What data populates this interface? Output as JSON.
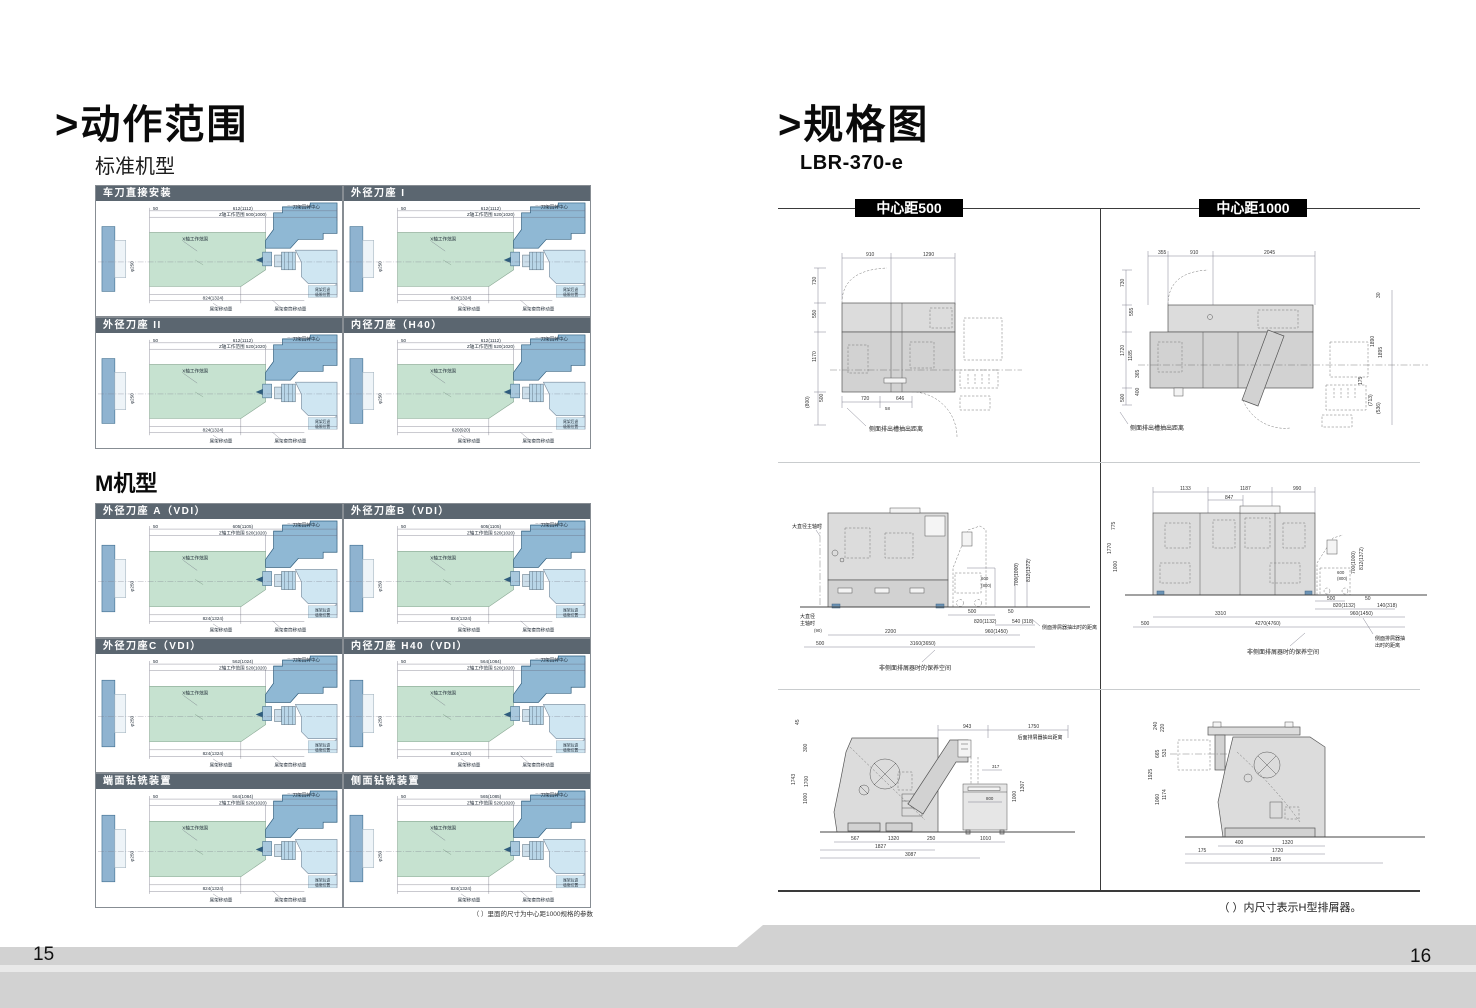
{
  "left_page": {
    "title": ">动作范围",
    "section_standard": "标准机型",
    "section_m": "M机型",
    "footnote": "（ ）里面的尺寸为中心距1000规格的参数",
    "page_number": "15",
    "common": {
      "turret_center": "刀架回转中心",
      "x_range": "X轴工作范围",
      "tailstock_travel": "尾架移动量",
      "quill_travel": "尾架套筒移动量",
      "retract_line1": "尾架后退",
      "retract_line2": "极限位置",
      "dim50": "50",
      "dim_phi": "φ250"
    },
    "standard_panels": [
      {
        "title": "车刀直接安装",
        "top_dim": "612(1112)",
        "z_range": "Z轴工作范围 500(1000)",
        "bottom_dim": "824(1324)"
      },
      {
        "title": "外径刀座 I",
        "top_dim": "612(1112)",
        "z_range": "Z轴工作范围 520(1020)",
        "bottom_dim": "824(1324)"
      },
      {
        "title": "外径刀座 II",
        "top_dim": "612(1112)",
        "z_range": "Z轴工作范围 520(1020)",
        "bottom_dim": "824(1324)"
      },
      {
        "title": "内径刀座（H40）",
        "top_dim": "612(1112)",
        "z_range": "Z轴工作范围 520(1020)",
        "bottom_dim": "620(920)"
      }
    ],
    "m_panels": [
      {
        "title": "外径刀座 A（VDI）",
        "top_dim": "605(1105)",
        "z_range": "Z轴工作范围 520(1020)",
        "bottom_dim": "824(1324)"
      },
      {
        "title": "外径刀座B（VDI）",
        "top_dim": "605(1105)",
        "z_range": "Z轴工作范围 520(1020)",
        "bottom_dim": "824(1324)"
      },
      {
        "title": "外径刀座C（VDI）",
        "top_dim": "562(1024)",
        "z_range": "Z轴工作范围 520(1020)",
        "bottom_dim": "824(1324)"
      },
      {
        "title": "内径刀座 H40（VDI）",
        "top_dim": "564(1084)",
        "z_range": "Z轴工作范围 520(1020)",
        "bottom_dim": "824(1324)"
      },
      {
        "title": "端面钻铣装置",
        "top_dim": "564(1084)",
        "z_range": "Z轴工作范围 520(1020)",
        "bottom_dim": "824(1324)"
      },
      {
        "title": "侧面钻铣装置",
        "top_dim": "565(1085)",
        "z_range": "Z轴工作范围 520(1020)",
        "bottom_dim": "824(1324)"
      }
    ]
  },
  "right_page": {
    "title": ">规格图",
    "model": "LBR-370-e",
    "col1_label": "中心距500",
    "col2_label": "中心距1000",
    "footnote": "（ ）内尺寸表示H型排屑器。",
    "page_number": "16",
    "d500_top": {
      "top": [
        "910",
        "1290"
      ],
      "left": [
        "730",
        "550",
        "1170",
        "(800)",
        "500"
      ],
      "bottom": [
        "720",
        "646",
        "58"
      ],
      "label": "侧面排出槽抽出距离"
    },
    "d1000_top": {
      "top": [
        "355",
        "910",
        "2045"
      ],
      "left": [
        "730",
        "555",
        "1720",
        "1185",
        "365",
        "400",
        "500"
      ],
      "right": [
        "30",
        "1890",
        "1895",
        "175",
        "(713)",
        "(536)"
      ],
      "label": "侧面排出槽抽出距离"
    },
    "d500_front": {
      "spindle_top": "大直径主轴时",
      "spindle_l1": "大直径",
      "spindle_l2": "主轴时",
      "dims": {
        "c600": "600",
        "c800": "(800)",
        "c700": "700(1000)",
        "c812": "812(1372)"
      },
      "bottom": [
        "500",
        "50",
        "820(1132)",
        "540 (318)",
        "2200",
        "960(1450)",
        "3160(3650)",
        "(90)",
        "500"
      ],
      "conveyor_label": "侧面排屑器抽出时的距离",
      "space_label": "非侧面排屑器时的保养空间"
    },
    "d1000_front": {
      "top": [
        "1133",
        "1187",
        "990",
        "847"
      ],
      "left": [
        "775",
        "1770",
        "1000"
      ],
      "dims": {
        "c600": "600",
        "c800": "(800)",
        "c700": "700(1000)",
        "c812": "812(1372)"
      },
      "bottom": [
        "500",
        "50",
        "820(1132)",
        "140(318)",
        "3310",
        "960(1450)",
        "4270(4760)",
        "500"
      ],
      "conveyor_l1": "侧面排屑器抽",
      "conveyor_l2": "出时的距离",
      "space_label": "非侧面排屑器时的保养空间"
    },
    "d500_side": {
      "top": [
        "45",
        "943",
        "1750"
      ],
      "rear_label": "后面排屑器抽出距离",
      "left": [
        "300",
        "1743",
        "1700",
        "1000"
      ],
      "right": [
        "317",
        "800",
        "1000",
        "1307"
      ],
      "bottom": [
        "567",
        "1320",
        "250",
        "1010",
        "1827",
        "3087"
      ]
    },
    "d1000_side": {
      "left": [
        "240",
        "220",
        "665",
        "531",
        "1925",
        "1060",
        "1174"
      ],
      "bottom": [
        "400",
        "1320",
        "175",
        "1720",
        "1895"
      ]
    }
  }
}
